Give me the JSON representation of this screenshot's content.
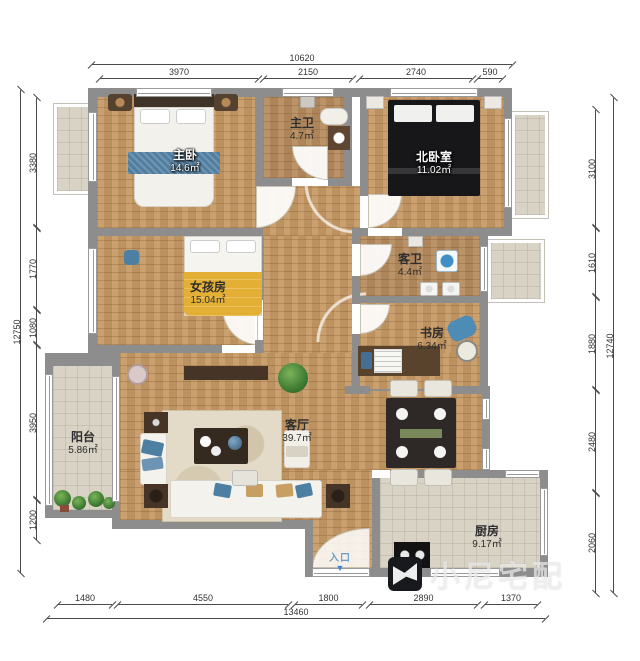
{
  "rooms": [
    {
      "id": "master-bedroom",
      "name": "主卧",
      "area": "14.6㎡"
    },
    {
      "id": "master-bathroom",
      "name": "主卫",
      "area": "4.7㎡"
    },
    {
      "id": "north-bedroom",
      "name": "北卧室",
      "area": "11.02㎡"
    },
    {
      "id": "girls-room",
      "name": "女孩房",
      "area": "15.04㎡"
    },
    {
      "id": "guest-bathroom",
      "name": "客卫",
      "area": "4.4㎡"
    },
    {
      "id": "study",
      "name": "书房",
      "area": "6.34㎡"
    },
    {
      "id": "balcony",
      "name": "阳台",
      "area": "5.86㎡"
    },
    {
      "id": "living-room",
      "name": "客厅",
      "area": "39.7㎡"
    },
    {
      "id": "kitchen",
      "name": "厨房",
      "area": "9.17㎡"
    }
  ],
  "entrance": {
    "label": "入口",
    "arrow_glyph": "▼"
  },
  "watermark": {
    "text": "小尼宅配"
  },
  "dimensions": {
    "top": {
      "overall": "10620",
      "segments": [
        "3970",
        "2150",
        "2740",
        "590"
      ]
    },
    "bottom": {
      "overall": "13460",
      "segments": [
        "1480",
        "4550",
        "1800",
        "2890",
        "1370"
      ]
    },
    "left": {
      "overall": "12750",
      "segments": [
        "3380",
        "1770",
        "1080",
        "3950",
        "1200"
      ]
    },
    "right": {
      "overall": "12740",
      "segments": [
        "3100",
        "1610",
        "1880",
        "2480",
        "2060"
      ]
    }
  },
  "colors": {
    "wall": "#8d8d8d",
    "wood_floor": "#c79a66",
    "bath_floor": "#b78c5f",
    "tile_floor": "#d9d3c6",
    "accent_blue": "#4d7fa3",
    "bed_yellow": "#e4af35",
    "entrance_blue": "#3d86d8",
    "plant_green": "#3f7d33"
  }
}
